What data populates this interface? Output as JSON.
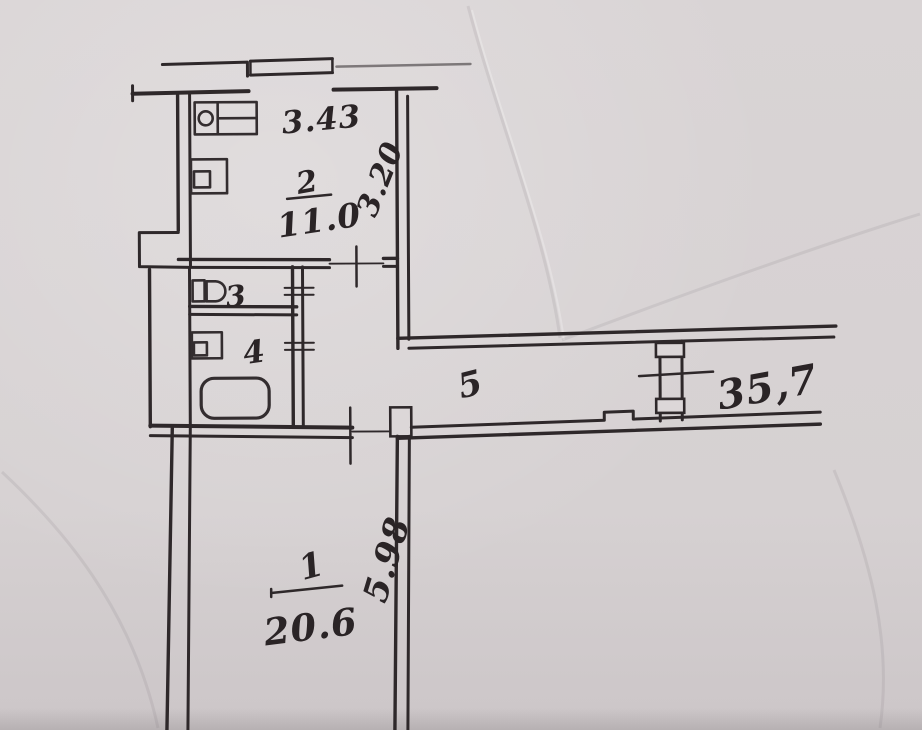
{
  "plan": {
    "rooms": [
      {
        "number": "1",
        "area": "20.6"
      },
      {
        "number": "2",
        "area": "11.0"
      },
      {
        "number": "3"
      },
      {
        "number": "4"
      },
      {
        "number": "5"
      }
    ],
    "dimensions": {
      "room2_width": "3.43",
      "room2_depth": "3.20",
      "room1_depth": "5.98"
    },
    "total_area": "35,7",
    "fixtures": [
      "kitchen-sink",
      "stove",
      "toilet",
      "wash-basin",
      "bathtub"
    ],
    "colors": {
      "paper": "#d6d1d2",
      "ink": "#2e282a"
    }
  }
}
